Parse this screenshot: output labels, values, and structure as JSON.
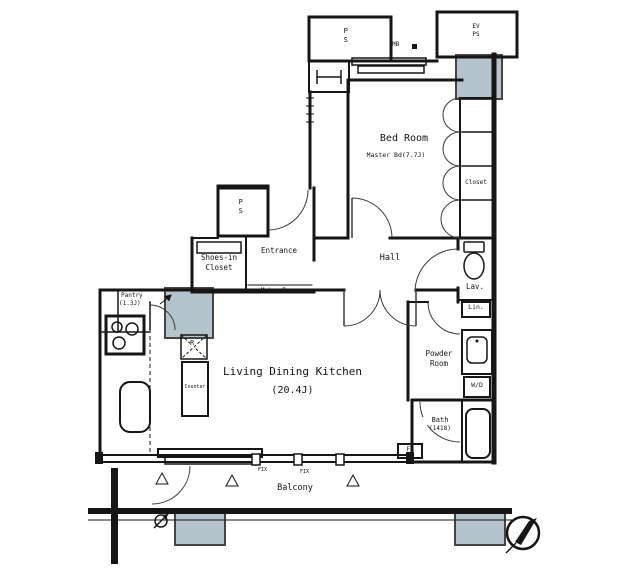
{
  "colors": {
    "shaded_fill": "#b4c3cc",
    "line": "#161616",
    "background": "#ffffff"
  },
  "labels": {
    "ps_top": "PS",
    "mb": "MB",
    "ev": {
      "line1": "EV",
      "line2": "PS"
    },
    "bedroom": {
      "name": "Bed Room",
      "size": "Master Bd(7.7J)"
    },
    "closet": "Closet",
    "shoes_closet": {
      "line1": "Shoes-in",
      "line2": "Closet"
    },
    "entrance": "Entrance",
    "entrance_note": "Meter Box",
    "hall": "Hall",
    "lav": "Lav.",
    "linen": "Lin.",
    "ps_entrance": "PS",
    "pantry": {
      "name": "Pantry",
      "size": "(1.3J)"
    },
    "refrigerator": "R",
    "counter": "Counter",
    "ldk": {
      "name": "Living Dining Kitchen",
      "size": "(20.4J)"
    },
    "powder": {
      "line1": "Powder",
      "line2": "Room"
    },
    "washer_dryer": "W/D",
    "bath": {
      "name": "Bath",
      "size": "(1418)"
    },
    "fs": "FS",
    "fix_left": "FIX",
    "fix_right": "FIX",
    "balcony": "Balcony"
  }
}
